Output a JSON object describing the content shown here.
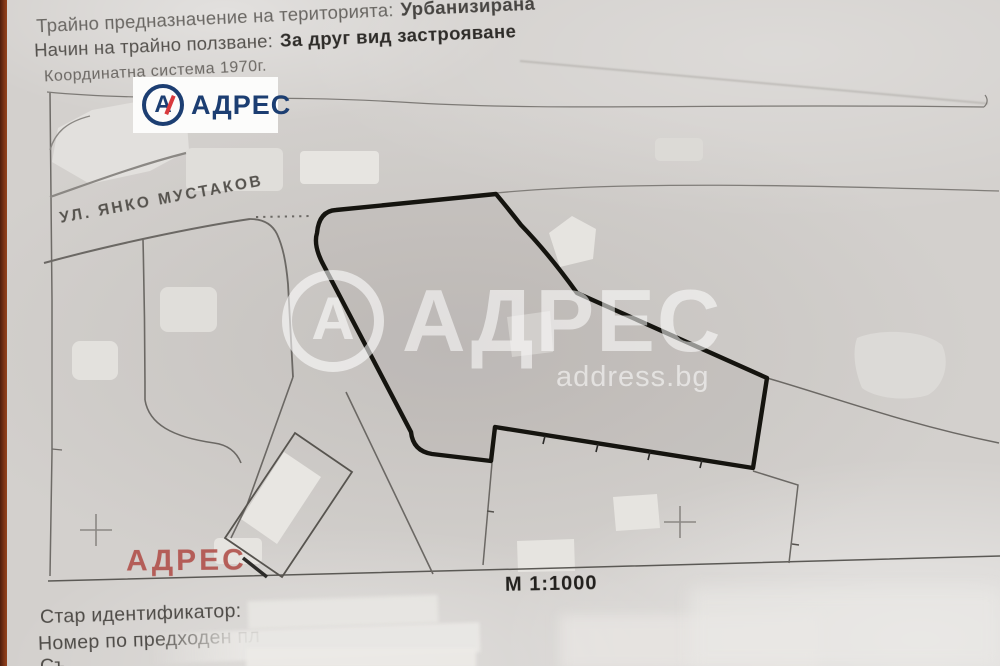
{
  "colors": {
    "brand_navy": "#1c3e72",
    "brand_red": "#d93a3d",
    "stamp_red": "#b2544e",
    "ink_dark": "#2e2c29",
    "ink_soft": "#55524e",
    "photo_edge_brown": "#7c3416",
    "paper_gray": "#d3d0cd",
    "boundary_black": "#15140f"
  },
  "header": {
    "line1_label": "Трайно предназначение на територията:",
    "line1_value": "Урбанизирана",
    "line2_label": "Начин на трайно ползване:",
    "line2_value": "За друг вид застрояване",
    "coordinate_system": "Координатна система 1970г."
  },
  "logo": {
    "monogram": "А",
    "brand": "АДРЕС"
  },
  "map": {
    "street_label": "УЛ. ЯНКО МУСТАКОВ",
    "scale_label": "М 1:1000",
    "stamp": "АДРЕС"
  },
  "watermark": {
    "monogram": "А",
    "brand": "АДРЕС",
    "domain": "address.bg"
  },
  "footer": {
    "line1_label": "Стар идентификатор:",
    "line2_label": "Номер по предходен пл",
    "line3_clipped": "Съ"
  }
}
